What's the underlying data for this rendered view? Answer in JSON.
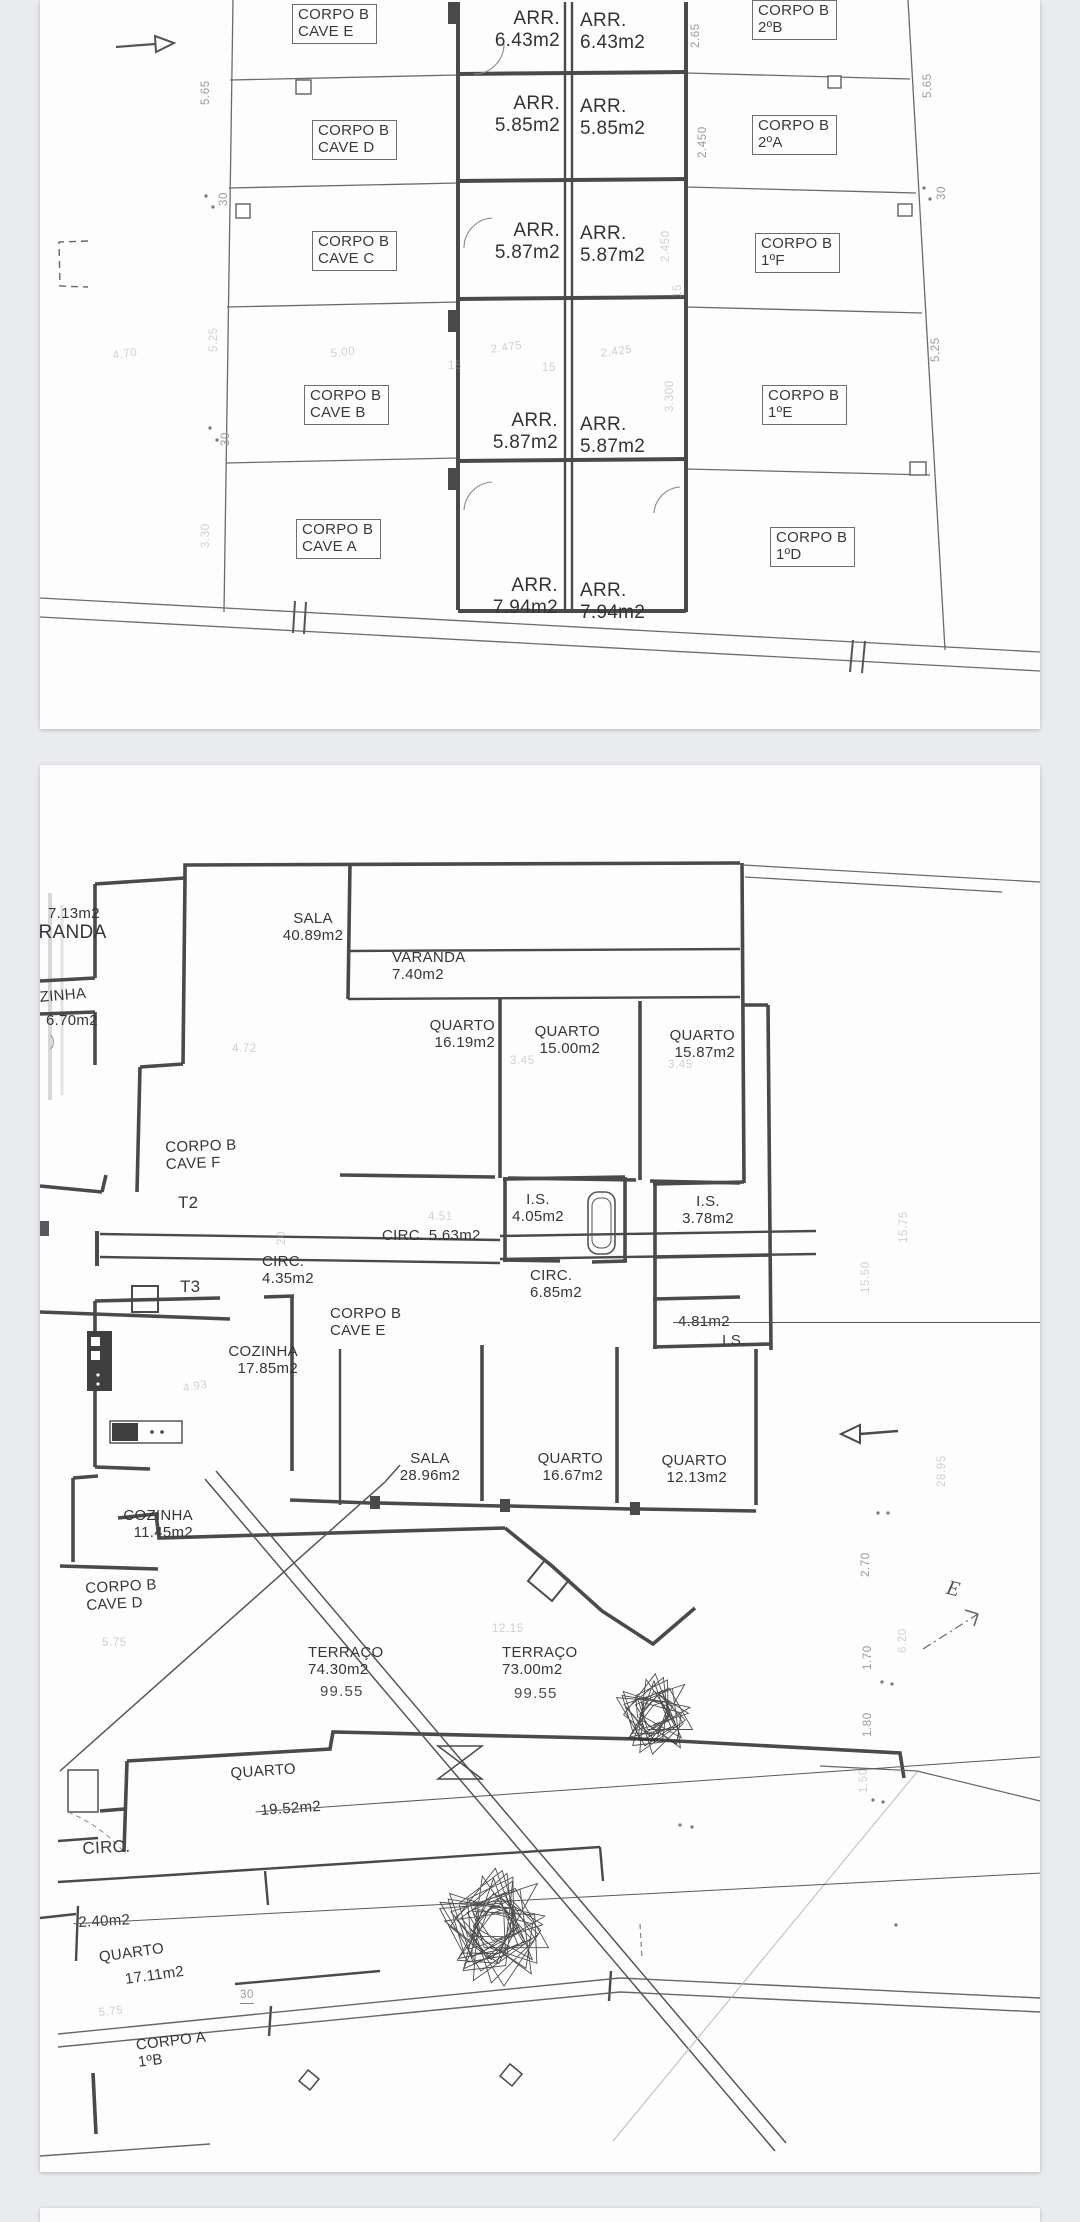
{
  "viewer": {
    "background": "#e9ebee",
    "page_color": "#fdfdfd"
  },
  "pages": [
    {
      "name": "basement-storage-plan",
      "labels": [
        {
          "text": "CORPO B\nCAVE E",
          "x": 252,
          "y": 4,
          "cls": "box"
        },
        {
          "text": "CORPO B\nCAVE D",
          "x": 272,
          "y": 120,
          "cls": "box"
        },
        {
          "text": "CORPO B\nCAVE C",
          "x": 272,
          "y": 231,
          "cls": "box"
        },
        {
          "text": "CORPO B\nCAVE B",
          "x": 264,
          "y": 385,
          "cls": "box"
        },
        {
          "text": "CORPO B\nCAVE A",
          "x": 256,
          "y": 519,
          "cls": "box"
        },
        {
          "text": "CORPO B\n2ºB",
          "x": 712,
          "y": 0,
          "cls": "box"
        },
        {
          "text": "CORPO B\n2ºA",
          "x": 712,
          "y": 115,
          "cls": "box"
        },
        {
          "text": "CORPO B\n1ºF",
          "x": 715,
          "y": 233,
          "cls": "box"
        },
        {
          "text": "CORPO B\n1ºE",
          "x": 722,
          "y": 385,
          "cls": "box"
        },
        {
          "text": "CORPO B\n1ºD",
          "x": 730,
          "y": 527,
          "cls": "box"
        },
        {
          "text": "ARR.\n6.43m2",
          "x": 420,
          "y": 8,
          "w": 100,
          "cls": "arr right"
        },
        {
          "text": "ARR.\n6.43m2",
          "x": 540,
          "y": 10,
          "w": 100,
          "cls": "arr left"
        },
        {
          "text": "ARR.\n5.85m2",
          "x": 420,
          "y": 93,
          "w": 100,
          "cls": "arr right"
        },
        {
          "text": "ARR.\n5.85m2",
          "x": 540,
          "y": 96,
          "w": 100,
          "cls": "arr left"
        },
        {
          "text": "ARR.\n5.87m2",
          "x": 420,
          "y": 220,
          "w": 100,
          "cls": "arr right"
        },
        {
          "text": "ARR.\n5.87m2",
          "x": 540,
          "y": 223,
          "w": 100,
          "cls": "arr left"
        },
        {
          "text": "ARR.\n5.87m2",
          "x": 418,
          "y": 410,
          "w": 100,
          "cls": "arr right"
        },
        {
          "text": "ARR.\n5.87m2",
          "x": 540,
          "y": 414,
          "w": 100,
          "cls": "arr left"
        },
        {
          "text": "ARR.\n7.94m2",
          "x": 418,
          "y": 575,
          "w": 100,
          "cls": "arr right"
        },
        {
          "text": "ARR.\n7.94m2",
          "x": 540,
          "y": 580,
          "w": 100,
          "cls": "arr left"
        },
        {
          "text": "2.65",
          "x": 650,
          "y": 48,
          "cls": "dim v"
        },
        {
          "text": "5.65",
          "x": 160,
          "y": 105,
          "cls": "dim v"
        },
        {
          "text": "5.65",
          "x": 882,
          "y": 98,
          "cls": "dim v"
        },
        {
          "text": "2.450",
          "x": 657,
          "y": 158,
          "cls": "dim v"
        },
        {
          "text": "30",
          "x": 178,
          "y": 206,
          "cls": "dim v"
        },
        {
          "text": "30",
          "x": 896,
          "y": 200,
          "cls": "dim v"
        },
        {
          "text": "2.450",
          "x": 620,
          "y": 262,
          "cls": "dim v faint"
        },
        {
          "text": "15",
          "x": 632,
          "y": 298,
          "cls": "dim v faint"
        },
        {
          "text": "5.25",
          "x": 168,
          "y": 352,
          "cls": "dim v faint"
        },
        {
          "text": "5.25",
          "x": 890,
          "y": 362,
          "cls": "dim v"
        },
        {
          "text": "4.70",
          "x": 72,
          "y": 350,
          "cls": "dim faint",
          "rot": -8
        },
        {
          "text": "5.00",
          "x": 290,
          "y": 348,
          "cls": "dim faint",
          "rot": -6
        },
        {
          "text": "15",
          "x": 408,
          "y": 360,
          "cls": "dim faint"
        },
        {
          "text": "2.475",
          "x": 450,
          "y": 344,
          "cls": "dim faint",
          "rot": -8
        },
        {
          "text": "15",
          "x": 502,
          "y": 362,
          "cls": "dim faint"
        },
        {
          "text": "2.425",
          "x": 560,
          "y": 348,
          "cls": "dim faint",
          "rot": -8
        },
        {
          "text": "3.300",
          "x": 624,
          "y": 412,
          "cls": "dim v faint"
        },
        {
          "text": "30",
          "x": 180,
          "y": 446,
          "cls": "dim v"
        },
        {
          "text": "3.30",
          "x": 160,
          "y": 548,
          "cls": "dim v faint"
        }
      ]
    },
    {
      "name": "apartments-terrace-plan",
      "labels": [
        {
          "text": "SALA\n40.89m2",
          "x": 218,
          "y": 145,
          "w": 110,
          "cls": "room center"
        },
        {
          "text": "7.13m2",
          "x": 8,
          "y": 140,
          "cls": "room"
        },
        {
          "text": "VARANDA",
          "x": -26,
          "y": 157,
          "cls": "room big2"
        },
        {
          "text": "VARANDA\n7.40m2",
          "x": 352,
          "y": 184,
          "w": 100,
          "cls": "room left"
        },
        {
          "text": "QUARTO\n16.19m2",
          "x": 360,
          "y": 252,
          "w": 95,
          "cls": "room right"
        },
        {
          "text": "QUARTO\n15.00m2",
          "x": 465,
          "y": 258,
          "w": 95,
          "cls": "room right"
        },
        {
          "text": "QUARTO\n15.87m2",
          "x": 600,
          "y": 262,
          "w": 95,
          "cls": "room right"
        },
        {
          "text": "COZINHA",
          "x": -24,
          "y": 226,
          "cls": "room",
          "rot": -5
        },
        {
          "text": "6.70m2",
          "x": 6,
          "y": 247,
          "cls": "room"
        },
        {
          "text": ")",
          "x": 10,
          "y": 268,
          "cls": "room faint"
        },
        {
          "text": "CORPO B\nCAVE F",
          "x": 125,
          "y": 374,
          "cls": "room",
          "rot": -2
        },
        {
          "text": "T2",
          "x": 138,
          "y": 428,
          "cls": "t23"
        },
        {
          "text": "CIRC. 5.63m2",
          "x": 342,
          "y": 462,
          "cls": "room"
        },
        {
          "text": "4.51",
          "x": 388,
          "y": 446,
          "cls": "dim faint"
        },
        {
          "text": "20",
          "x": 236,
          "y": 480,
          "cls": "dim v faint"
        },
        {
          "text": "CIRC.\n4.35m2",
          "x": 222,
          "y": 488,
          "w": 85,
          "cls": "room left"
        },
        {
          "text": "T3",
          "x": 140,
          "y": 512,
          "cls": "t23"
        },
        {
          "text": "CORPO B\nCAVE E",
          "x": 290,
          "y": 540,
          "cls": "room"
        },
        {
          "text": "I.S.\n4.05m2",
          "x": 458,
          "y": 426,
          "w": 80,
          "cls": "room center"
        },
        {
          "text": "I.S.\n3.78m2",
          "x": 628,
          "y": 428,
          "w": 80,
          "cls": "room center"
        },
        {
          "text": "CIRC.\n6.85m2",
          "x": 490,
          "y": 502,
          "w": 80,
          "cls": "room left"
        },
        {
          "text": "4.81m2",
          "x": 638,
          "y": 548,
          "cls": "room strike"
        },
        {
          "text": "I.S.",
          "x": 682,
          "y": 567,
          "cls": "room"
        },
        {
          "text": "COZINHA\n17.85m2",
          "x": 148,
          "y": 578,
          "w": 110,
          "cls": "room right"
        },
        {
          "text": "4.93",
          "x": 142,
          "y": 618,
          "cls": "dim faint",
          "rot": -10
        },
        {
          "text": "4.72",
          "x": 192,
          "y": 278,
          "cls": "dim faint"
        },
        {
          "text": "3.45",
          "x": 470,
          "y": 290,
          "cls": "dim faint"
        },
        {
          "text": "3.45",
          "x": 628,
          "y": 294,
          "cls": "dim faint"
        },
        {
          "text": "SALA\n28.96m2",
          "x": 340,
          "y": 685,
          "w": 100,
          "cls": "room center"
        },
        {
          "text": "QUARTO\n16.67m2",
          "x": 468,
          "y": 685,
          "w": 95,
          "cls": "room right"
        },
        {
          "text": "QUARTO\n12.13m2",
          "x": 592,
          "y": 687,
          "w": 95,
          "cls": "room right"
        },
        {
          "text": "COZINHA\n11.45m2",
          "x": 48,
          "y": 742,
          "w": 105,
          "cls": "room right"
        },
        {
          "text": "CORPO B\nCAVE D",
          "x": 45,
          "y": 815,
          "cls": "room",
          "rot": -3
        },
        {
          "text": "5.75",
          "x": 62,
          "y": 872,
          "cls": "dim faint"
        },
        {
          "text": "12.15",
          "x": 452,
          "y": 858,
          "cls": "dim faint"
        },
        {
          "text": "TERRAÇO\n74.30m2",
          "x": 268,
          "y": 879,
          "w": 95,
          "cls": "room left"
        },
        {
          "text": "99.55",
          "x": 280,
          "y": 918,
          "cls": "t99"
        },
        {
          "text": "TERRAÇO\n73.00m2",
          "x": 462,
          "y": 879,
          "w": 95,
          "cls": "room left"
        },
        {
          "text": "99.55",
          "x": 474,
          "y": 920,
          "cls": "t99"
        },
        {
          "text": "QUARTO",
          "x": 190,
          "y": 1000,
          "cls": "room",
          "rot": -4
        },
        {
          "text": "19.52m2",
          "x": 220,
          "y": 1020,
          "cls": "room strike",
          "rot": -4
        },
        {
          "text": "CIRC.",
          "x": 42,
          "y": 1074,
          "cls": "t23",
          "rot": -3
        },
        {
          "text": "2.40m2",
          "x": 38,
          "y": 1114,
          "cls": "room strike",
          "rot": -3
        },
        {
          "text": "QUARTO",
          "x": 58,
          "y": 1184,
          "cls": "room",
          "rot": -8
        },
        {
          "text": "17.11m2",
          "x": 84,
          "y": 1206,
          "cls": "room",
          "rot": -8
        },
        {
          "text": "30",
          "x": 200,
          "y": 1224,
          "cls": "dim ul"
        },
        {
          "text": "5.75",
          "x": 58,
          "y": 1242,
          "cls": "dim faint",
          "rot": -6
        },
        {
          "text": "CORPO A\n1ºB",
          "x": 95,
          "y": 1272,
          "cls": "room",
          "rot": -7
        },
        {
          "text": "15.75",
          "x": 858,
          "y": 478,
          "cls": "dim v faint"
        },
        {
          "text": "15.50",
          "x": 820,
          "y": 528,
          "cls": "dim v faint"
        },
        {
          "text": "28.95",
          "x": 896,
          "y": 722,
          "cls": "dim v faint"
        },
        {
          "text": "2.70",
          "x": 820,
          "y": 812,
          "cls": "dim v"
        },
        {
          "text": "6.20",
          "x": 857,
          "y": 888,
          "cls": "dim v faint"
        },
        {
          "text": "1.70",
          "x": 822,
          "y": 905,
          "cls": "dim v"
        },
        {
          "text": "1.80",
          "x": 822,
          "y": 972,
          "cls": "dim v"
        },
        {
          "text": "1.50",
          "x": 818,
          "y": 1028,
          "cls": "dim v faint"
        },
        {
          "text": "E",
          "x": 910,
          "y": 810,
          "cls": "emark"
        }
      ]
    },
    {
      "name": "next-page-sliver",
      "labels": []
    }
  ]
}
